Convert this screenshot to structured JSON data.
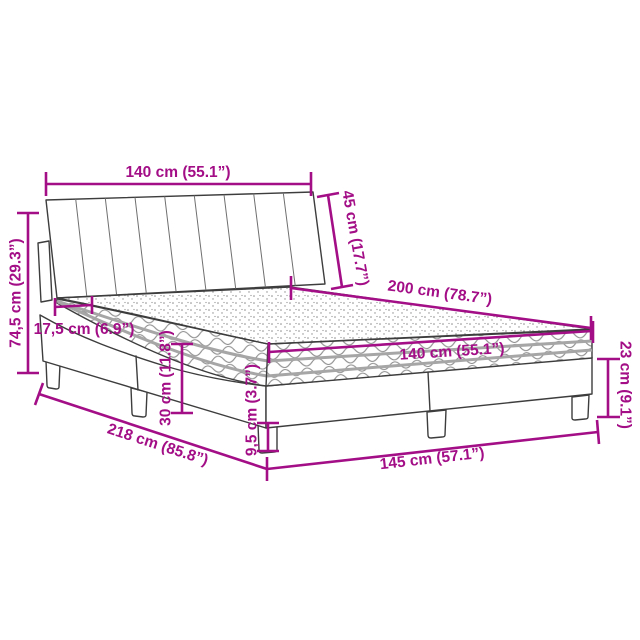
{
  "page": {
    "background": "#ffffff",
    "description": "Technical dimension diagram of an upholstered bed with pleated headboard, spring mattress and wave-shaped base on legs"
  },
  "diagram": {
    "accent_color": "#a30e87",
    "line_color": "#3d3d3d",
    "labels": {
      "headboard_width": "140 cm (55.1”)",
      "headboard_height": "45 cm (17.7”)",
      "overall_height": "74,5 cm (29.3”)",
      "mattress_inset": "17,5 cm (6.9”)",
      "bed_length": "200 cm (78.7”)",
      "mattress_width": "140 cm (55.1”)",
      "mattress_height": "30 cm (11.8”)",
      "base_height": "23 cm (9.1”)",
      "overall_length": "218 cm (85.8”)",
      "leg_height": "9,5 cm (3.7”)",
      "overall_width": "145 cm (57.1”)"
    }
  }
}
